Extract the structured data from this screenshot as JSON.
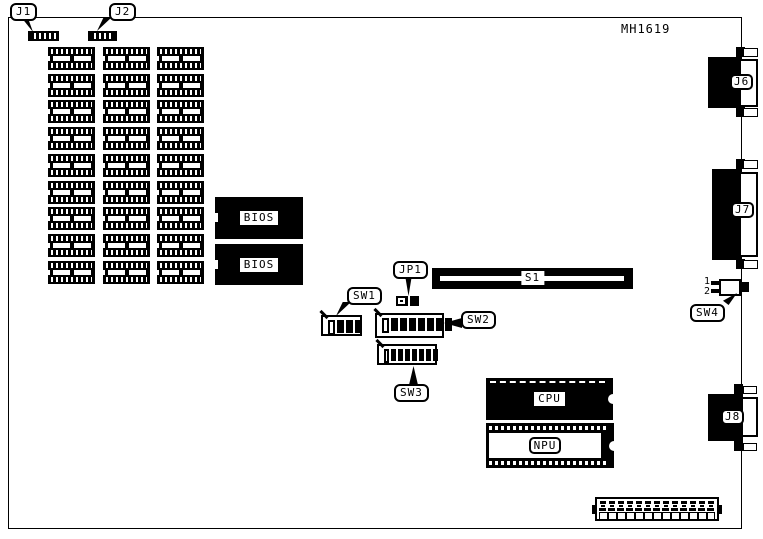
{
  "board": {
    "part_number": "MH1619"
  },
  "callouts": {
    "j1": "J1",
    "j2": "J2",
    "jp1": "JP1",
    "sw1": "SW1",
    "sw2": "SW2",
    "sw3": "SW3",
    "sw4": "SW4"
  },
  "components": {
    "bios_top": "BIOS",
    "bios_bottom": "BIOS",
    "cpu": "CPU",
    "npu": "NPU",
    "s1": "S1"
  },
  "port_labels": {
    "j6": "J6",
    "j7": "J7",
    "j8": "J8"
  },
  "sw4": {
    "pin1_label": "1",
    "pin2_label": "2"
  },
  "memory_grid": {
    "columns": 3,
    "rows": 9
  },
  "dip_switches": {
    "sw1": {
      "positions": 4,
      "off_first": true
    },
    "sw2": {
      "positions": 8,
      "off_first": true
    },
    "sw3": {
      "positions": 8,
      "off_first": true
    }
  }
}
